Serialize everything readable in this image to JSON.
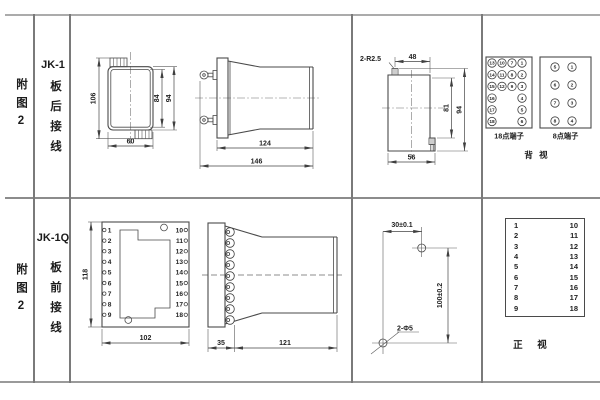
{
  "rows": [
    {
      "figure": "附图2",
      "model": "JK-1",
      "wiring": "板后接线"
    },
    {
      "figure": "附图2",
      "model": "JK-1Q",
      "wiring": "板前接线"
    }
  ],
  "jk1_front": {
    "dim_total_height": "106",
    "dim_inner_height": "84",
    "dim_outer_height": "94",
    "dim_width": "60"
  },
  "jk1_side": {
    "dim_body_depth": "124",
    "dim_total_depth": "146"
  },
  "panel_cutout": {
    "corner_note": "2-R2.5",
    "dim_top_width": "48",
    "dim_inner_height": "81",
    "dim_outer_height": "94",
    "dim_bottom_width": "56"
  },
  "rear_view": {
    "terminal18": {
      "label": "18点端子",
      "columns": [
        [
          13,
          14,
          15,
          16,
          17,
          18
        ],
        [
          10,
          11,
          12
        ],
        [
          7,
          8,
          9
        ],
        [
          1,
          2,
          3,
          4,
          5,
          6
        ]
      ]
    },
    "terminal8": {
      "label": "8点端子",
      "columns": [
        [
          5,
          6,
          7,
          8
        ],
        [
          1,
          2,
          3,
          4
        ]
      ]
    },
    "caption": "背 视"
  },
  "jk1q_front": {
    "left_terminals": [
      1,
      2,
      3,
      4,
      5,
      6,
      7,
      8,
      9
    ],
    "right_terminals": [
      10,
      11,
      12,
      13,
      14,
      15,
      16,
      17,
      18
    ],
    "dim_height": "118",
    "dim_width": "102"
  },
  "jk1q_side": {
    "dim_flange": "35",
    "dim_body": "121"
  },
  "drill_plan": {
    "dim_horizontal": "30±0.1",
    "dim_vertical": "100±0.2",
    "hole_note": "2-Φ5"
  },
  "front_view_table": {
    "left_column": [
      1,
      2,
      3,
      4,
      5,
      6,
      7,
      8,
      9
    ],
    "right_column": [
      10,
      11,
      12,
      13,
      14,
      15,
      16,
      17,
      18
    ],
    "caption": "正 视"
  }
}
